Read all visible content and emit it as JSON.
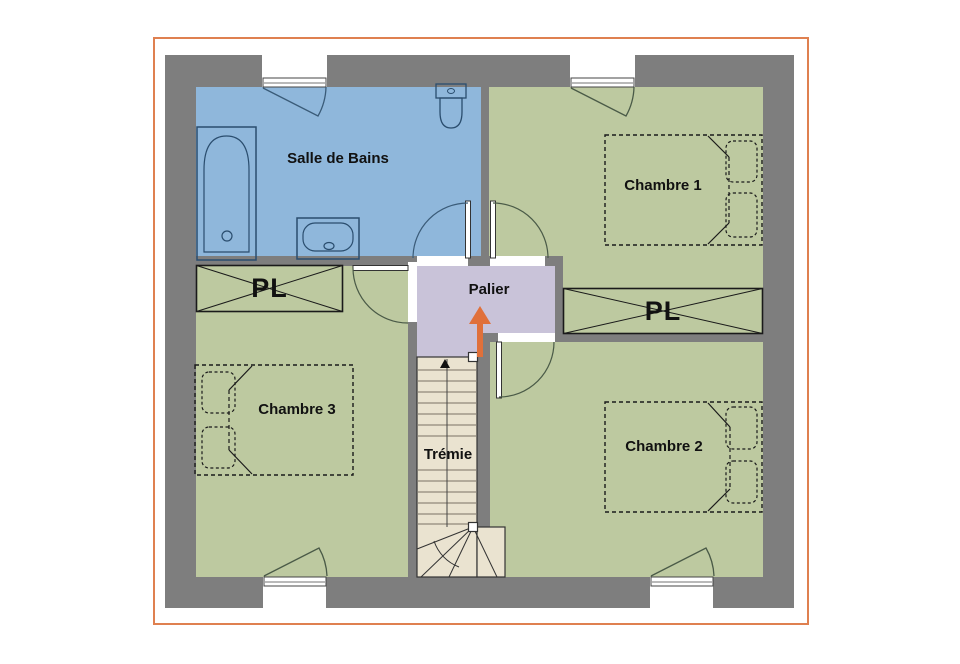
{
  "plan": {
    "type": "floor-plan-etage",
    "frame_color": "#DF8050",
    "wall_color": "#7E7E7E",
    "arrow_color": "#E0703A",
    "rooms": {
      "bathroom": {
        "label": "Salle de Bains",
        "color": "#8FB7DB"
      },
      "bedroom1": {
        "label": "Chambre 1",
        "color": "#BDC9A0"
      },
      "bedroom2": {
        "label": "Chambre 2",
        "color": "#BDC9A0"
      },
      "bedroom3": {
        "label": "Chambre 3",
        "color": "#BDC9A0"
      },
      "landing": {
        "label": "Palier",
        "color": "#C9C3D9"
      },
      "stairwell": {
        "label": "Trémie",
        "color": "#EAE3D0"
      }
    },
    "closets": {
      "left": {
        "label": "PL"
      },
      "right": {
        "label": "PL"
      }
    }
  }
}
